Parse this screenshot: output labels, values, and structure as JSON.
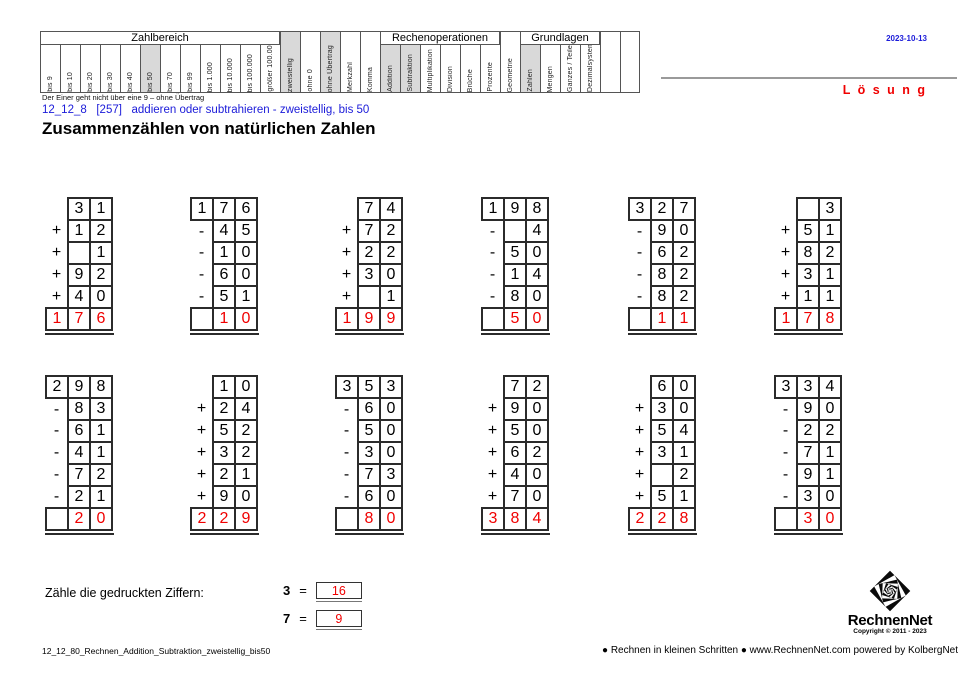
{
  "colors": {
    "blue": "#1b1bd9",
    "red": "#f00000",
    "highlight": "#d9d9d9",
    "border_dark": "#2b2b2b",
    "border_gray": "#555555"
  },
  "page": {
    "date": "2023-10-13",
    "solution_label": "L ö s u n g",
    "note": "Der Einer geht nicht über eine 9 – ohne Übertrag",
    "subtitle": "12_12_8   [257]   addieren oder subtrahieren - zweistellig, bis 50",
    "title": "Zusammenzählen von natürlichen Zahlen"
  },
  "header_table": {
    "sections": [
      {
        "group": "Zahlbereich",
        "columns": [
          {
            "label": "bis 9",
            "hl": false
          },
          {
            "label": "bis 10",
            "hl": false
          },
          {
            "label": "bis 20",
            "hl": false
          },
          {
            "label": "bis 30",
            "hl": false
          },
          {
            "label": "bis 40",
            "hl": false
          },
          {
            "label": "bis 50",
            "hl": true
          },
          {
            "label": "bis 70",
            "hl": false
          },
          {
            "label": "bis 99",
            "hl": false
          },
          {
            "label": "bis 1.000",
            "hl": false
          },
          {
            "label": "bis 10.000",
            "hl": false
          },
          {
            "label": "bis 100.000",
            "hl": false
          },
          {
            "label": "größer 100.000",
            "hl": false
          }
        ]
      },
      {
        "group": null,
        "columns": [
          {
            "label": "zweistellig",
            "hl": true
          },
          {
            "label": "ohne 0",
            "hl": false
          },
          {
            "label": "ohne Übertrag",
            "hl": true
          },
          {
            "label": "Merkzahl",
            "hl": false
          },
          {
            "label": "Komma",
            "hl": false
          }
        ]
      },
      {
        "group": "Rechenoperationen",
        "columns": [
          {
            "label": "Addition",
            "hl": true
          },
          {
            "label": "Subtraktion",
            "hl": true
          },
          {
            "label": "Multiplikation",
            "hl": false
          },
          {
            "label": "Division",
            "hl": false
          },
          {
            "label": "Brüche",
            "hl": false
          },
          {
            "label": "Prozente",
            "hl": false
          }
        ]
      },
      {
        "group": null,
        "columns": [
          {
            "label": "Geometrie",
            "hl": false
          }
        ]
      },
      {
        "group": "Grundlagen",
        "columns": [
          {
            "label": "Zahlen",
            "hl": true
          },
          {
            "label": "Mengen",
            "hl": false
          },
          {
            "label": "Ganzes / Teile",
            "hl": false
          },
          {
            "label": "Dezimalsystem",
            "hl": false
          }
        ]
      },
      {
        "group": null,
        "columns": [
          {
            "label": "",
            "hl": false
          },
          {
            "label": "",
            "hl": false
          }
        ]
      }
    ]
  },
  "problems": {
    "row1": [
      {
        "first": [
          null,
          "3",
          "1"
        ],
        "ops": [
          [
            "+",
            "1",
            "2"
          ],
          [
            "+",
            "",
            "1"
          ],
          [
            "+",
            "9",
            "2"
          ],
          [
            "+",
            "4",
            "0"
          ]
        ],
        "result": [
          "1",
          "7",
          "6"
        ]
      },
      {
        "first": [
          "1",
          "7",
          "6"
        ],
        "ops": [
          [
            "-",
            "4",
            "5"
          ],
          [
            "-",
            "1",
            "0"
          ],
          [
            "-",
            "6",
            "0"
          ],
          [
            "-",
            "5",
            "1"
          ]
        ],
        "result": [
          "",
          "1",
          "0"
        ]
      },
      {
        "first": [
          null,
          "7",
          "4"
        ],
        "ops": [
          [
            "+",
            "7",
            "2"
          ],
          [
            "+",
            "2",
            "2"
          ],
          [
            "+",
            "3",
            "0"
          ],
          [
            "+",
            "",
            "1"
          ]
        ],
        "result": [
          "1",
          "9",
          "9"
        ]
      },
      {
        "first": [
          "1",
          "9",
          "8"
        ],
        "ops": [
          [
            "-",
            "",
            "4"
          ],
          [
            "-",
            "5",
            "0"
          ],
          [
            "-",
            "1",
            "4"
          ],
          [
            "-",
            "8",
            "0"
          ]
        ],
        "result": [
          "",
          "5",
          "0"
        ]
      },
      {
        "first": [
          "3",
          "2",
          "7"
        ],
        "ops": [
          [
            "-",
            "9",
            "0"
          ],
          [
            "-",
            "6",
            "2"
          ],
          [
            "-",
            "8",
            "2"
          ],
          [
            "-",
            "8",
            "2"
          ]
        ],
        "result": [
          "",
          "1",
          "1"
        ]
      },
      {
        "first": [
          null,
          "",
          "3"
        ],
        "ops": [
          [
            "+",
            "5",
            "1"
          ],
          [
            "+",
            "8",
            "2"
          ],
          [
            "+",
            "3",
            "1"
          ],
          [
            "+",
            "1",
            "1"
          ]
        ],
        "result": [
          "1",
          "7",
          "8"
        ]
      }
    ],
    "row2": [
      {
        "first": [
          "2",
          "9",
          "8"
        ],
        "ops": [
          [
            "-",
            "8",
            "3"
          ],
          [
            "-",
            "6",
            "1"
          ],
          [
            "-",
            "4",
            "1"
          ],
          [
            "-",
            "7",
            "2"
          ],
          [
            "-",
            "2",
            "1"
          ]
        ],
        "result": [
          "",
          "2",
          "0"
        ]
      },
      {
        "first": [
          null,
          "1",
          "0"
        ],
        "ops": [
          [
            "+",
            "2",
            "4"
          ],
          [
            "+",
            "5",
            "2"
          ],
          [
            "+",
            "3",
            "2"
          ],
          [
            "+",
            "2",
            "1"
          ],
          [
            "+",
            "9",
            "0"
          ]
        ],
        "result": [
          "2",
          "2",
          "9"
        ]
      },
      {
        "first": [
          "3",
          "5",
          "3"
        ],
        "ops": [
          [
            "-",
            "6",
            "0"
          ],
          [
            "-",
            "5",
            "0"
          ],
          [
            "-",
            "3",
            "0"
          ],
          [
            "-",
            "7",
            "3"
          ],
          [
            "-",
            "6",
            "0"
          ]
        ],
        "result": [
          "",
          "8",
          "0"
        ]
      },
      {
        "first": [
          null,
          "7",
          "2"
        ],
        "ops": [
          [
            "+",
            "9",
            "0"
          ],
          [
            "+",
            "5",
            "0"
          ],
          [
            "+",
            "6",
            "2"
          ],
          [
            "+",
            "4",
            "0"
          ],
          [
            "+",
            "7",
            "0"
          ]
        ],
        "result": [
          "3",
          "8",
          "4"
        ]
      },
      {
        "first": [
          null,
          "6",
          "0"
        ],
        "ops": [
          [
            "+",
            "3",
            "0"
          ],
          [
            "+",
            "5",
            "4"
          ],
          [
            "+",
            "3",
            "1"
          ],
          [
            "+",
            "",
            "2"
          ],
          [
            "+",
            "5",
            "1"
          ]
        ],
        "result": [
          "2",
          "2",
          "8"
        ]
      },
      {
        "first": [
          "3",
          "3",
          "4"
        ],
        "ops": [
          [
            "-",
            "9",
            "0"
          ],
          [
            "-",
            "2",
            "2"
          ],
          [
            "-",
            "7",
            "1"
          ],
          [
            "-",
            "9",
            "1"
          ],
          [
            "-",
            "3",
            "0"
          ]
        ],
        "result": [
          "",
          "3",
          "0"
        ]
      }
    ]
  },
  "counting": {
    "prompt": "Zähle die gedruckten Ziffern:",
    "items": [
      {
        "digit": "3",
        "equals": "=",
        "count": "16"
      },
      {
        "digit": "7",
        "equals": "=",
        "count": "9"
      }
    ]
  },
  "footer": {
    "filename": "12_12_80_Rechnen_Addition_Subtraktion_zweistellig_bis50",
    "slogan": "● Rechnen in kleinen Schritten ●",
    "website": "www.RechnenNet.com powered by KolbergNet",
    "logo_text": "RechnenNet",
    "copyright": "Copyright © 2011 - 2023"
  }
}
